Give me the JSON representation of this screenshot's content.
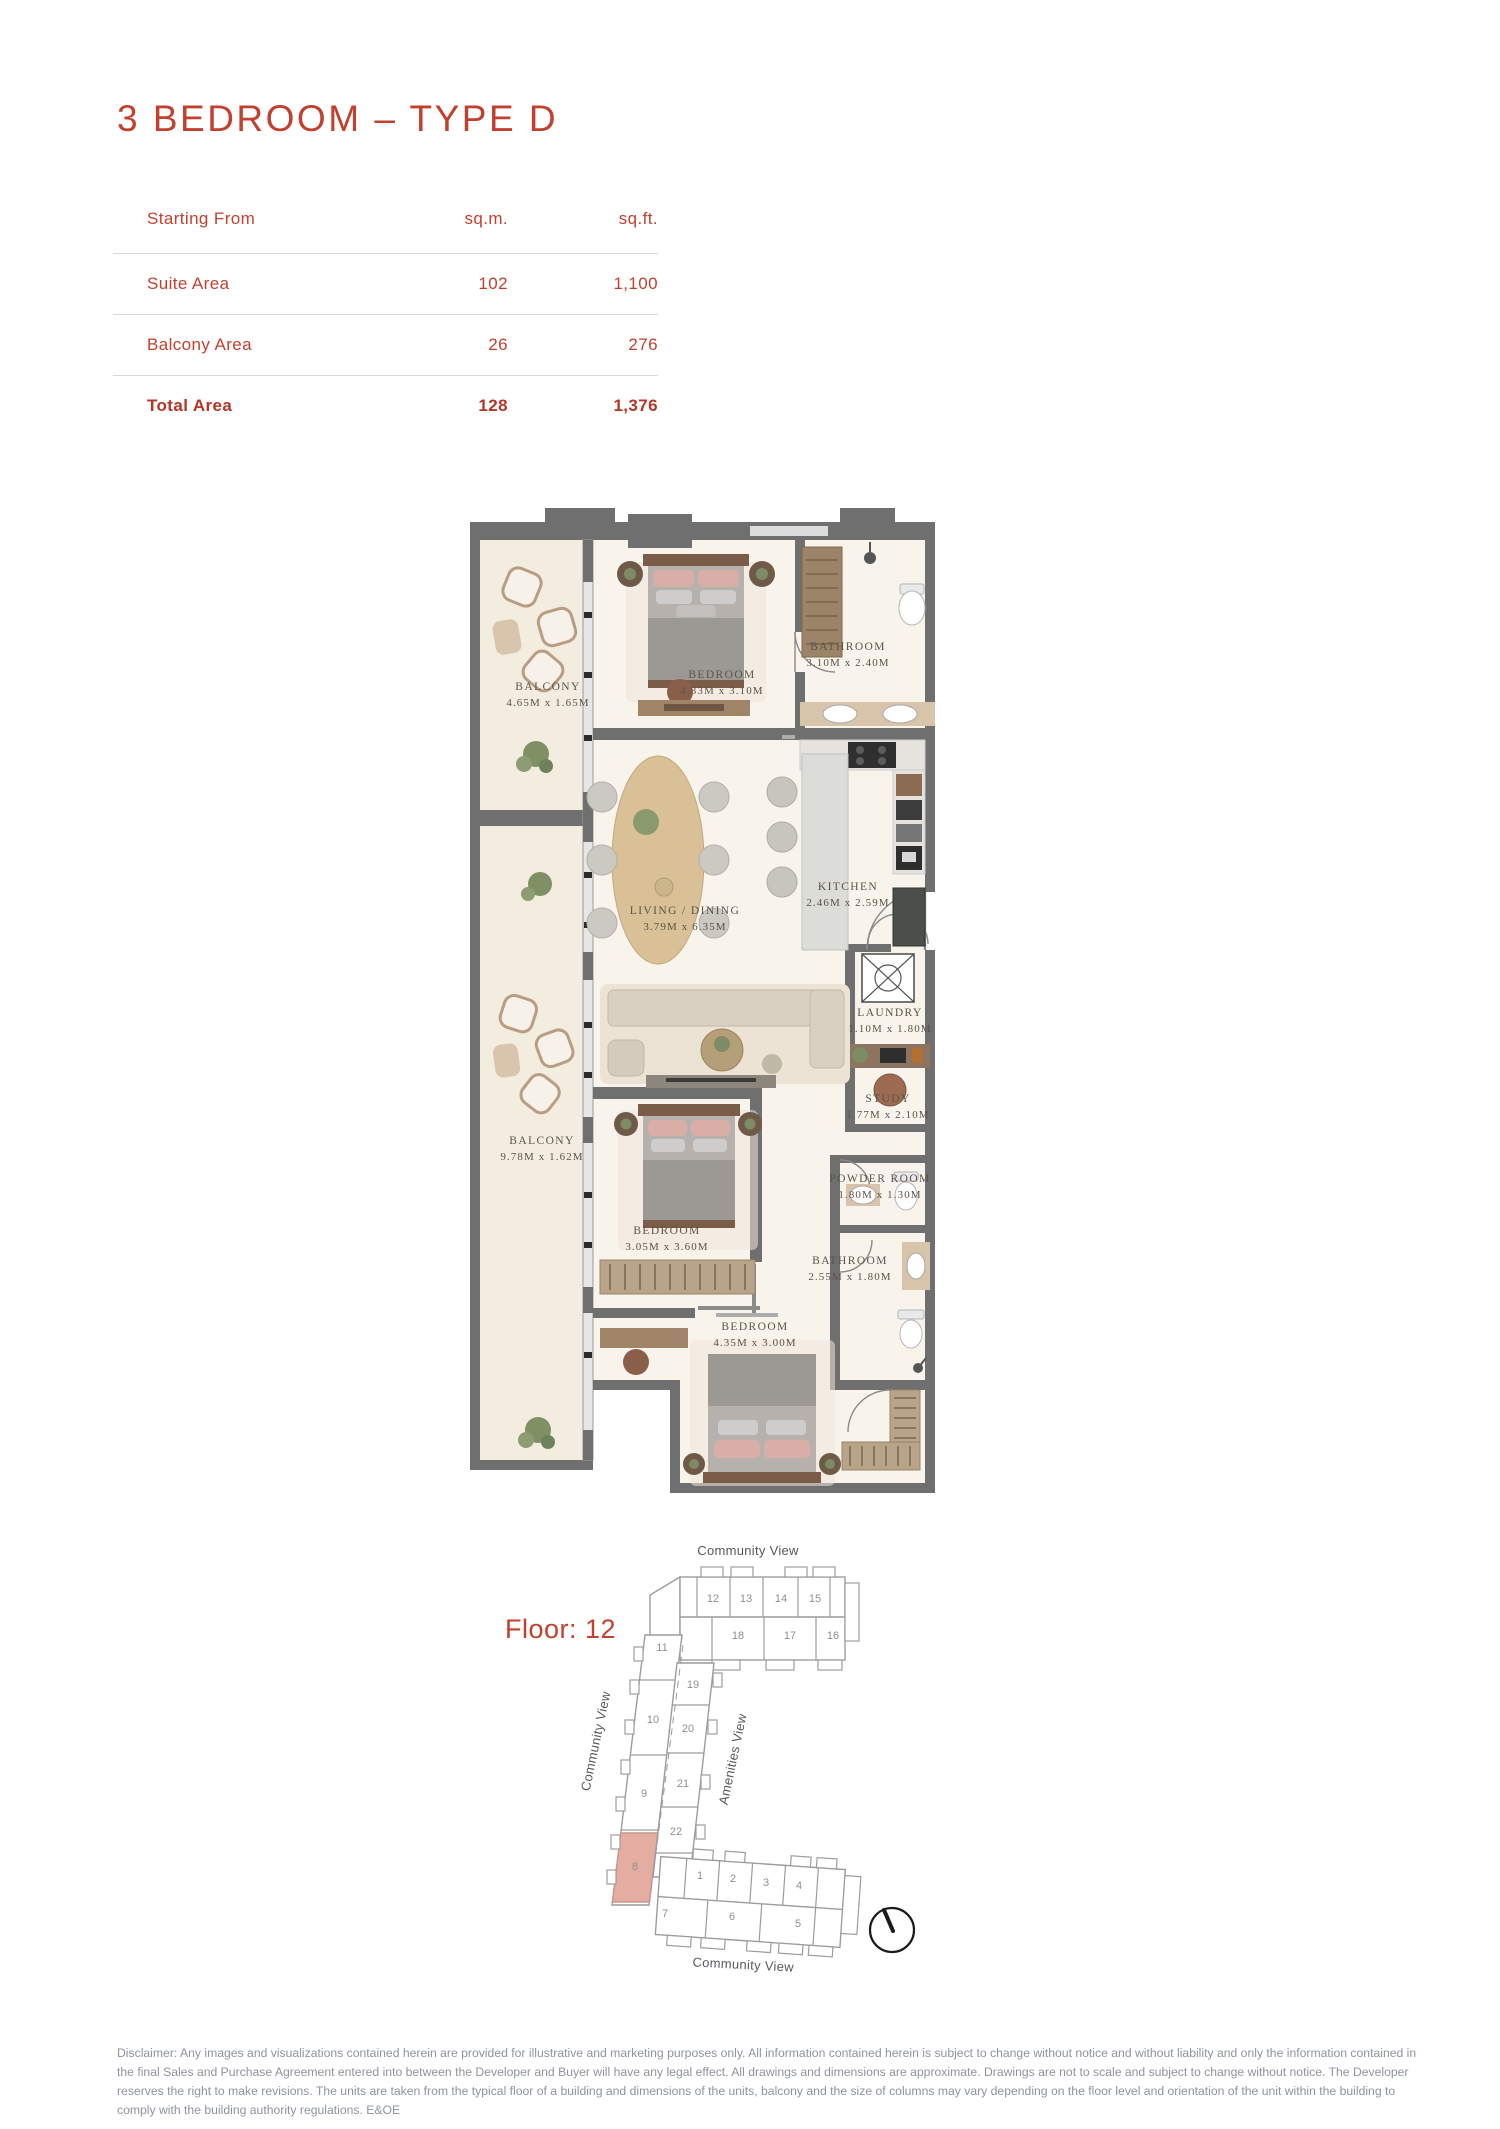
{
  "page": {
    "title": "3 BEDROOM – TYPE D"
  },
  "colors": {
    "accent": "#c2402e",
    "highlight_unit": "#e5ada1",
    "wall": "#6f6f6f",
    "floor": "#f8f4ec",
    "balcony_floor": "#f3eddf"
  },
  "area_table": {
    "header": {
      "label": "Starting From",
      "col_sqm": "sq.m.",
      "col_sqft": "sq.ft."
    },
    "rows": [
      {
        "label": "Suite Area",
        "sqm": "102",
        "sqft": "1,100"
      },
      {
        "label": "Balcony Area",
        "sqm": "26",
        "sqft": "276"
      },
      {
        "label": "Total Area",
        "sqm": "128",
        "sqft": "1,376"
      }
    ]
  },
  "floor_plan": {
    "rooms": [
      {
        "name": "BALCONY",
        "dims": "4.65M x 1.65M"
      },
      {
        "name": "BEDROOM",
        "dims": "4.33M x 3.10M"
      },
      {
        "name": "BATHROOM",
        "dims": "3.10M x 2.40M"
      },
      {
        "name": "LIVING / DINING",
        "dims": "3.79M x 6.35M"
      },
      {
        "name": "KITCHEN",
        "dims": "2.46M x 2.59M"
      },
      {
        "name": "LAUNDRY",
        "dims": "1.10M x 1.80M"
      },
      {
        "name": "STUDY",
        "dims": "1.77M x 2.10M"
      },
      {
        "name": "BALCONY",
        "dims": "9.78M x 1.62M"
      },
      {
        "name": "BEDROOM",
        "dims": "3.05M x 3.60M"
      },
      {
        "name": "POWDER ROOM",
        "dims": "1.80M x 1.30M"
      },
      {
        "name": "BATHROOM",
        "dims": "2.55M x 1.80M"
      },
      {
        "name": "BEDROOM",
        "dims": "4.35M x 3.00M"
      }
    ]
  },
  "keyplan": {
    "floor_label": "Floor: 12",
    "highlighted_unit": "8",
    "views": {
      "top": "Community View",
      "left": "Community View",
      "diagonal": "Amenities View",
      "bottom": "Community View"
    },
    "units": [
      {
        "label": "12"
      },
      {
        "label": "13"
      },
      {
        "label": "14"
      },
      {
        "label": "15"
      },
      {
        "label": "18"
      },
      {
        "label": "17"
      },
      {
        "label": "16"
      },
      {
        "label": "11"
      },
      {
        "label": "19"
      },
      {
        "label": "10"
      },
      {
        "label": "20"
      },
      {
        "label": "9"
      },
      {
        "label": "21"
      },
      {
        "label": "22"
      },
      {
        "label": "8"
      },
      {
        "label": "1"
      },
      {
        "label": "2"
      },
      {
        "label": "3"
      },
      {
        "label": "4"
      },
      {
        "label": "7"
      },
      {
        "label": "6"
      },
      {
        "label": "5"
      }
    ]
  },
  "disclaimer": "Disclaimer: Any images and visualizations contained herein are provided for illustrative and marketing purposes only. All information contained herein is subject to change without notice and without liability and only the information contained in the final Sales and Purchase Agreement entered into between the Developer and Buyer will have any legal effect. All drawings and dimensions are approximate. Drawings are not to scale and subject to change without notice. The Developer reserves the right to make revisions. The units are taken from the typical floor of a building and dimensions of the units, balcony and the size of columns may vary depending on the floor level and orientation of the unit within the building to comply with the building authority regulations. E&OE"
}
